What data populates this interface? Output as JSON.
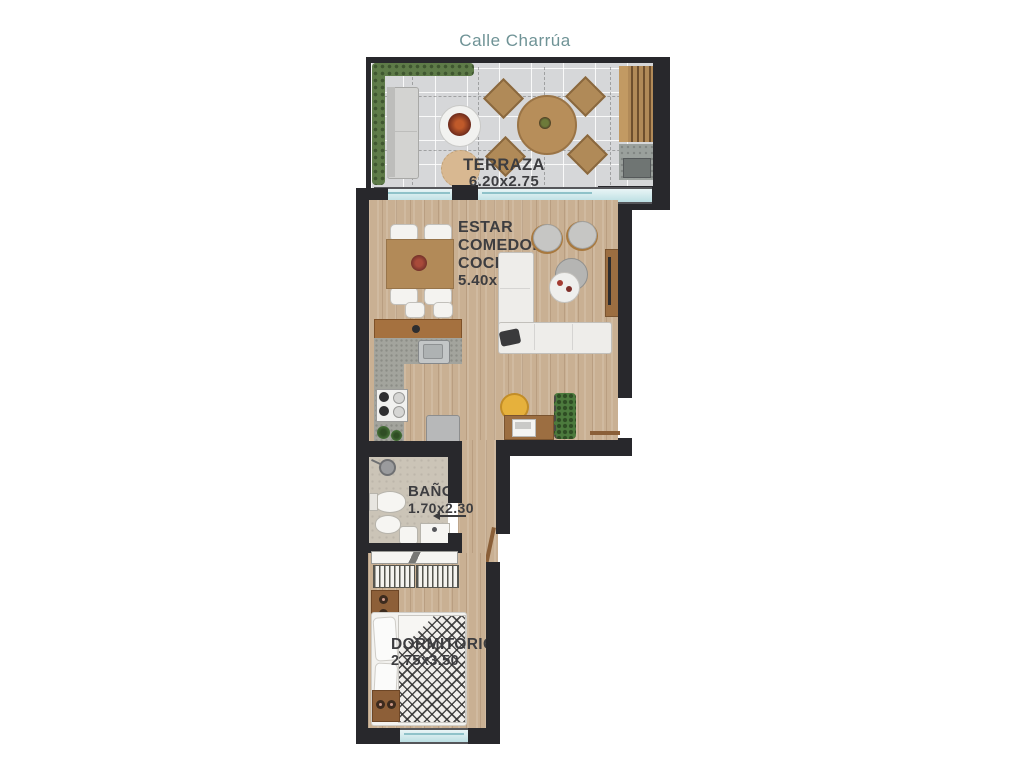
{
  "street_label": "Calle Charrúa",
  "rooms": {
    "terraza": {
      "name": "TERRAZA",
      "dims": "6.20x2.75"
    },
    "estar": {
      "line1": "ESTAR",
      "line2": "COMEDOR",
      "line3": "COCINA",
      "dims": "5.40x5.15"
    },
    "bano": {
      "name": "BAÑO",
      "dims": "1.70x2.30"
    },
    "dormitorio": {
      "name": "DORMITORIO",
      "dims": "2.75x3.50"
    }
  },
  "colors": {
    "street_text": "#6f9396",
    "wall": "#28282c",
    "label_text": "#3d3d40",
    "wood_floor": "#c9b093",
    "terrace_tile": "#d6d7d9",
    "glass": "#bcdfe3"
  }
}
